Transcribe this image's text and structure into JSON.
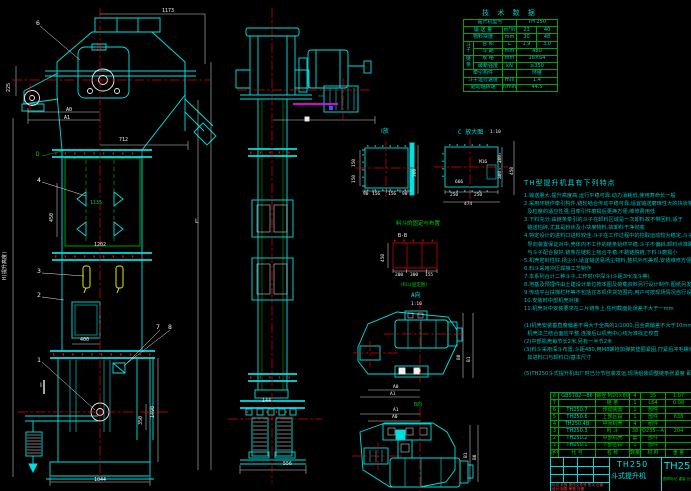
{
  "tech_table": {
    "title": "技 术 数 据",
    "rows": [
      [
        {
          "t": "提升机型号",
          "cs": 3
        },
        {
          "t": "TH 250",
          "cs": 2
        }
      ],
      [
        {
          "t": "输 送 量",
          "cs": 2
        },
        {
          "t": "m³/h"
        },
        {
          "t": "23"
        },
        {
          "t": "40"
        }
      ],
      [
        {
          "t": "物料块度",
          "cs": 2
        },
        {
          "t": "mm"
        },
        {
          "t": "30"
        },
        {
          "t": "48"
        }
      ],
      [
        {
          "t": "斗子",
          "rs": 2
        },
        {
          "t": "容 积"
        },
        {
          "t": "L"
        },
        {
          "t": "1.9"
        },
        {
          "t": "3.0"
        }
      ],
      [
        {
          "t": "斗 距"
        },
        {
          "t": "mm"
        },
        {
          "t": "480",
          "cs": 2
        }
      ],
      [
        {
          "t": "链条",
          "rs": 2
        },
        {
          "t": "规 格"
        },
        {
          "t": "mm"
        },
        {
          "t": "18×64",
          "cs": 2
        }
      ],
      [
        {
          "t": "破断强度"
        },
        {
          "t": "kN"
        },
        {
          "t": "≥350",
          "cs": 2
        }
      ],
      [
        {
          "t": "牵引构件",
          "cs": 2
        },
        {
          "t": ""
        },
        {
          "t": "环链",
          "cs": 2
        }
      ],
      [
        {
          "t": "斗子运行速度",
          "cs": 2
        },
        {
          "t": "m/s"
        },
        {
          "t": "1.4",
          "cs": 2
        }
      ],
      [
        {
          "t": "驱动轴转速",
          "cs": 2
        },
        {
          "t": "r/min"
        },
        {
          "t": "44.5",
          "cs": 2
        }
      ]
    ]
  },
  "notes": {
    "title": "TH型提升机具有下列特点",
    "lines": [
      "1.输送量大,提升高度高,运行平稳可靠,动力消耗低,使用寿命长一般",
      "2.采用环链作牵引构件,链轮啮合传动平稳可靠,适宜输送磨琢性大的块状物料,对物料温度",
      "  及粒度的适应性强,且牵引件磨损后更换方便,维修费用低",
      "3.下料充分:由链条牵引的斗子在卸料区域是一次卸料故不带回料,适于",
      "  输送怕碎,尤其是粉状及小块度物料,故卸料干净彻底",
      "4.特定设计的进料口进料较佳,斗子在工作过程中的挖取运动较为稳定,斗子上,下行均设有",
      "  导向装置保证对中,壳体内不工作的链条始终平稳,斗子不偏斜,卸料点准确度高,工作链条",
      "  与斗子配合良好,链条在链轮上啮合平稳,不跳链脱链,下料斗磨损小",
      "5.机壳密封性好,扬尘小,适宜输送易扬尘物料,整机外形美观,安装维修方便,运转费用低",
      "6.料斗采用冲压焊接工艺制作",
      "7.本系列合计二种斗子,工作时(中深斗)斗距3H(浅斗等).",
      "8.地基及预埋件由土建设计单位按本图及荷载资料另行设计制作,图纸另发",
      "9.传动平台扶梯栏杆等不包括在本机供货范围内,用户可按现场情况自行设计制作,要求如下",
      "10.安装时中部机壳对接",
      "11.机壳对中安装要求在二片链条上,任何截面处误差不大于一mm",
      "",
      "(1)机壳安装垂直度偏差不得大于全高的1/1000,且全高偏差不大于10mm,",
      "  机壳法兰结合面应平整,连接后以机壳中心线为准找正校直",
      "(2)中部机壳每节长2米,另有一半节2米",
      "(3)料斗采用深斗布置,斗距480,用M8螺栓加弹簧垫圈紧固,拧紧后冲毛螺纹2~3扣防松",
      "  其进料口与卸料口/基本尺寸",
      "",
      "(5)TH250斗式提升机出厂时已分节包装发运,现场组装调整链条张紧度 即可."
    ]
  },
  "bom": {
    "headers": [
      "序号",
      "代 号",
      "名 称",
      "数量",
      "材 料",
      "重 量"
    ],
    "rows": [
      [
        "8",
        "GB5782—86",
        "螺栓 M20×80",
        "4",
        "35",
        "1.07"
      ],
      [
        "7",
        "",
        "链 条",
        "1",
        "L64",
        "0.08"
      ],
      [
        "6",
        "TH250.7",
        "传动装置",
        "1",
        "部件",
        ""
      ],
      [
        "5",
        "TH250.6",
        "上部区段",
        "1",
        "部件",
        "638"
      ],
      [
        "4",
        "TH250.4B",
        "中间机壳",
        "4",
        "组件",
        ""
      ],
      [
        "3",
        "TH250.3",
        "料 斗",
        "38",
        "Q235—A",
        "204"
      ],
      [
        "2",
        "TH250.2",
        "中部机壳",
        "套",
        "部件",
        ""
      ],
      [
        "1",
        "TH250.1",
        "下部区段",
        "1",
        "部件",
        ""
      ]
    ]
  },
  "title_block": {
    "model": "TH250",
    "product": "斗式提升机",
    "drawing_no": "TH250",
    "rev_row": "标记 处数 更改文件号 签字 日期",
    "sign_row": "设计  制图  审核  日期",
    "stamp_row": "图样标记  重量  比例"
  },
  "labels": [
    {
      "t": "1173",
      "x": 162,
      "y": 9,
      "c": "w"
    },
    {
      "t": "6",
      "x": 36,
      "y": 20,
      "c": "w",
      "fs": 6.5
    },
    {
      "t": "225",
      "x": 7,
      "y": 92,
      "c": "w",
      "r": -90
    },
    {
      "t": "A0",
      "x": 66,
      "y": 108,
      "c": "w"
    },
    {
      "t": "A1",
      "x": 64,
      "y": 116,
      "c": "w"
    },
    {
      "t": "712",
      "x": 119,
      "y": 138,
      "c": "w"
    },
    {
      "t": "D",
      "x": 36,
      "y": 152,
      "c": "g",
      "fs": 6
    },
    {
      "t": "4",
      "x": 37,
      "y": 177,
      "c": "w",
      "fs": 6.5
    },
    {
      "t": "450",
      "x": 50,
      "y": 222,
      "c": "w",
      "r": -90
    },
    {
      "t": "1135",
      "x": 90,
      "y": 201,
      "c": "g"
    },
    {
      "t": "1202",
      "x": 94,
      "y": 243,
      "c": "w"
    },
    {
      "t": "3",
      "x": 37,
      "y": 268,
      "c": "w",
      "fs": 6.5
    },
    {
      "t": "2",
      "x": 37,
      "y": 292,
      "c": "w",
      "fs": 6.5
    },
    {
      "t": "L",
      "x": 195,
      "y": 219,
      "c": "w",
      "fs": 6
    },
    {
      "t": "H(提升高度)",
      "x": 3,
      "y": 280,
      "c": "w",
      "r": -90
    },
    {
      "t": "400",
      "x": 80,
      "y": 338,
      "c": "w"
    },
    {
      "t": "7",
      "x": 156,
      "y": 324,
      "c": "w",
      "fs": 6.5
    },
    {
      "t": "8",
      "x": 168,
      "y": 324,
      "c": "w",
      "fs": 6.5
    },
    {
      "t": "1",
      "x": 37,
      "y": 357,
      "c": "w",
      "fs": 6.5
    },
    {
      "t": "Ⅰ",
      "x": 40,
      "y": 382,
      "c": "w",
      "fs": 6.5
    },
    {
      "t": "1490",
      "x": 151,
      "y": 418,
      "c": "w",
      "r": -90
    },
    {
      "t": "350",
      "x": 139,
      "y": 425,
      "c": "w",
      "r": -90
    },
    {
      "t": "1044",
      "x": 94,
      "y": 478,
      "c": "w"
    },
    {
      "t": "144",
      "x": 262,
      "y": 399,
      "c": "w"
    },
    {
      "t": "556",
      "x": 283,
      "y": 462,
      "c": "w"
    },
    {
      "t": "Ⅰ放",
      "x": 381,
      "y": 129,
      "c": "c",
      "fs": 6
    },
    {
      "t": "150",
      "x": 353,
      "y": 167,
      "c": "w",
      "r": -90,
      "fs": 4.5
    },
    {
      "t": "150",
      "x": 353,
      "y": 183,
      "c": "w",
      "r": -90,
      "fs": 4.5
    },
    {
      "t": "360",
      "x": 414,
      "y": 177,
      "c": "w",
      "r": -90,
      "fs": 4.5
    },
    {
      "t": "90",
      "x": 363,
      "y": 193,
      "c": "w",
      "fs": 4.5
    },
    {
      "t": "156",
      "x": 372,
      "y": 193,
      "c": "w",
      "fs": 4.5
    },
    {
      "t": "156",
      "x": 388,
      "y": 193,
      "c": "w",
      "fs": 4.5
    },
    {
      "t": "90",
      "x": 402,
      "y": 193,
      "c": "w",
      "fs": 4.5
    },
    {
      "t": "C 放大图",
      "x": 458,
      "y": 130,
      "c": "c",
      "fs": 6
    },
    {
      "t": "1:10",
      "x": 490,
      "y": 131,
      "c": "w",
      "fs": 4.5
    },
    {
      "t": "M16",
      "x": 479,
      "y": 161,
      "c": "w",
      "fs": 4.5
    },
    {
      "t": "666",
      "x": 455,
      "y": 181,
      "c": "w",
      "fs": 4.5
    },
    {
      "t": "250",
      "x": 450,
      "y": 194,
      "c": "w",
      "fs": 4.5
    },
    {
      "t": "250",
      "x": 474,
      "y": 194,
      "c": "w",
      "fs": 4.5
    },
    {
      "t": "474",
      "x": 464,
      "y": 203,
      "c": "w",
      "fs": 4.5
    },
    {
      "t": "200",
      "x": 499,
      "y": 163,
      "c": "w",
      "r": -90,
      "fs": 4.5
    },
    {
      "t": "200",
      "x": 499,
      "y": 179,
      "c": "w",
      "r": -90,
      "fs": 4.5
    },
    {
      "t": "450",
      "x": 511,
      "y": 175,
      "c": "w",
      "r": -90,
      "fs": 4.5
    },
    {
      "t": "料斗的固定与布置",
      "x": 396,
      "y": 222,
      "c": "g",
      "fs": 5.5
    },
    {
      "t": "B-B",
      "x": 398,
      "y": 234,
      "c": "w",
      "fs": 5
    },
    {
      "t": "450",
      "x": 382,
      "y": 262,
      "c": "w",
      "r": -90,
      "fs": 4.5
    },
    {
      "t": "200",
      "x": 395,
      "y": 274,
      "c": "w",
      "fs": 4.5
    },
    {
      "t": "300",
      "x": 410,
      "y": 274,
      "c": "w",
      "fs": 4.5
    },
    {
      "t": "155",
      "x": 425,
      "y": 274,
      "c": "w",
      "fs": 4.5
    },
    {
      "t": "(料斗固定图)",
      "x": 400,
      "y": 284,
      "c": "g",
      "fs": 4.5
    },
    {
      "t": "A向",
      "x": 411,
      "y": 293,
      "c": "c",
      "fs": 6
    },
    {
      "t": "1:10",
      "x": 411,
      "y": 303,
      "c": "w",
      "fs": 4.5
    },
    {
      "t": "B0",
      "x": 458,
      "y": 360,
      "c": "w",
      "r": -90,
      "fs": 4.5
    },
    {
      "t": "B1",
      "x": 468,
      "y": 362,
      "c": "w",
      "r": -90,
      "fs": 4.5
    },
    {
      "t": "A0",
      "x": 393,
      "y": 386,
      "c": "w",
      "fs": 4.5
    },
    {
      "t": "A1",
      "x": 390,
      "y": 393,
      "c": "w",
      "fs": 4.5
    },
    {
      "t": "B向",
      "x": 414,
      "y": 403,
      "c": "g",
      "fs": 5
    },
    {
      "t": "A1",
      "x": 393,
      "y": 409,
      "c": "w",
      "fs": 4.5
    },
    {
      "t": "A0",
      "x": 392,
      "y": 416,
      "c": "w",
      "fs": 4.5
    },
    {
      "t": "B1",
      "x": 465,
      "y": 458,
      "c": "w",
      "r": -90,
      "fs": 4.5
    },
    {
      "t": "B0",
      "x": 474,
      "y": 460,
      "c": "w",
      "r": -90,
      "fs": 4.5
    }
  ]
}
